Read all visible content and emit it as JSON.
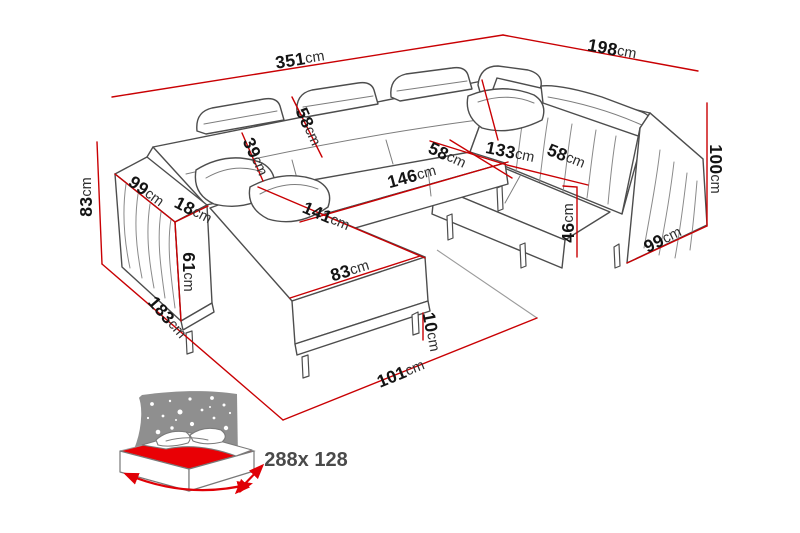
{
  "diagram": {
    "type": "furniture-dimension-diagram",
    "subject": "U-shaped corner sofa with sleeping function",
    "accent_color": "#c90003",
    "line_color": "#4d4d4d",
    "dimensions": [
      {
        "id": "total-width",
        "value": "351",
        "unit": "cm"
      },
      {
        "id": "total-depth-right",
        "value": "198",
        "unit": "cm"
      },
      {
        "id": "side-height-left",
        "value": "83",
        "unit": "cm"
      },
      {
        "id": "arm-depth-left",
        "value": "99",
        "unit": "cm"
      },
      {
        "id": "arm-width",
        "value": "18",
        "unit": "cm"
      },
      {
        "id": "arm-height",
        "value": "61",
        "unit": "cm"
      },
      {
        "id": "chaise-floor-depth",
        "value": "183",
        "unit": "cm"
      },
      {
        "id": "backrest-lower",
        "value": "39",
        "unit": "cm"
      },
      {
        "id": "backrest-upper",
        "value": "58",
        "unit": "cm"
      },
      {
        "id": "chaise-length",
        "value": "141",
        "unit": "cm"
      },
      {
        "id": "chaise-width",
        "value": "83",
        "unit": "cm"
      },
      {
        "id": "middle-seat-length",
        "value": "146",
        "unit": "cm"
      },
      {
        "id": "middle-seat-depth",
        "value": "58",
        "unit": "cm"
      },
      {
        "id": "right-seat-length",
        "value": "133",
        "unit": "cm"
      },
      {
        "id": "right-seat-depth",
        "value": "58",
        "unit": "cm"
      },
      {
        "id": "seat-height",
        "value": "46",
        "unit": "cm"
      },
      {
        "id": "leg-height",
        "value": "10",
        "unit": "cm"
      },
      {
        "id": "front-floor-width",
        "value": "101",
        "unit": "cm"
      },
      {
        "id": "arm-depth-right",
        "value": "99",
        "unit": "cm"
      },
      {
        "id": "back-height-right",
        "value": "100",
        "unit": "cm"
      }
    ],
    "sleeping_area": {
      "label": "288x 128",
      "icon": "sleeping-function-bed-icon",
      "mattress_color": "#e90005",
      "panel_color": "#8f8f8f"
    }
  }
}
